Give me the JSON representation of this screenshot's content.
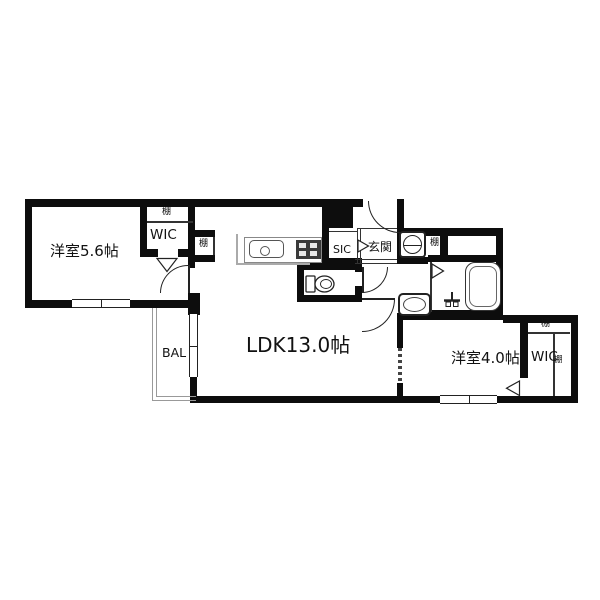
{
  "floorplan": {
    "rooms": {
      "bedroom_left": {
        "label": "洋室5.6帖"
      },
      "ldk": {
        "label": "LDK13.0帖"
      },
      "bedroom_right": {
        "label": "洋室4.0帖"
      },
      "wic_left": {
        "label": "WIC"
      },
      "wic_right": {
        "label": "WIC"
      },
      "sic": {
        "label": "SIC"
      },
      "genkan": {
        "label": "玄関"
      },
      "balcony": {
        "label": "BAL"
      }
    },
    "shelves": {
      "wic_left_top": "棚",
      "ldk_niche": "棚",
      "laundry_niche": "棚",
      "wic_right_top": "棚",
      "wic_right_side": "棚"
    },
    "colors": {
      "wall": "#0d0d0d",
      "background": "#ffffff",
      "fixture_outline": "#222222",
      "balcony_line": "#999999"
    }
  }
}
